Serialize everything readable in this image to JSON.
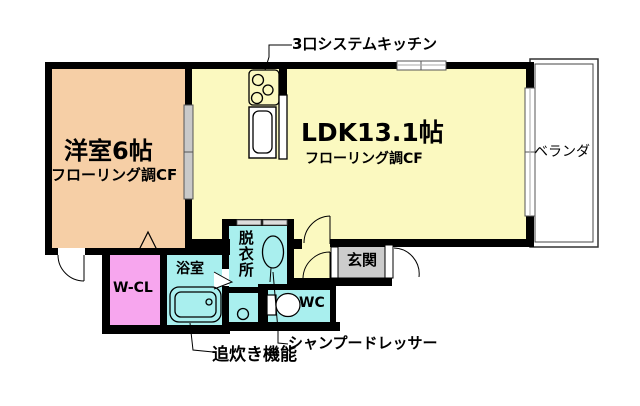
{
  "document": {
    "type": "apartment-floor-plan"
  },
  "rooms": {
    "western_room": {
      "name": "洋室6帖",
      "floor": "フローリング調CF"
    },
    "ldk": {
      "name": "LDK13.1帖",
      "floor": "フローリング調CF"
    },
    "veranda": {
      "name": "ベランダ"
    },
    "walk_in_closet": {
      "name": "W-CL"
    },
    "bathroom": {
      "name": "浴室"
    },
    "dressing_room": {
      "name": "脱衣所"
    },
    "toilet": {
      "name": "WC"
    },
    "entrance": {
      "name": "玄関"
    }
  },
  "annotations": {
    "kitchen": "3口システムキッチン",
    "reheating": "追炊き機能",
    "shampoo_dresser": "シャンプードレッサー"
  },
  "colors": {
    "western_room": "#f6cfa6",
    "ldk": "#fbf9c0",
    "walk_in_closet": "#f7a6ee",
    "wet_rooms": "#a9efee",
    "entrance": "#cccccc",
    "wall": "#000000",
    "white": "#ffffff"
  }
}
